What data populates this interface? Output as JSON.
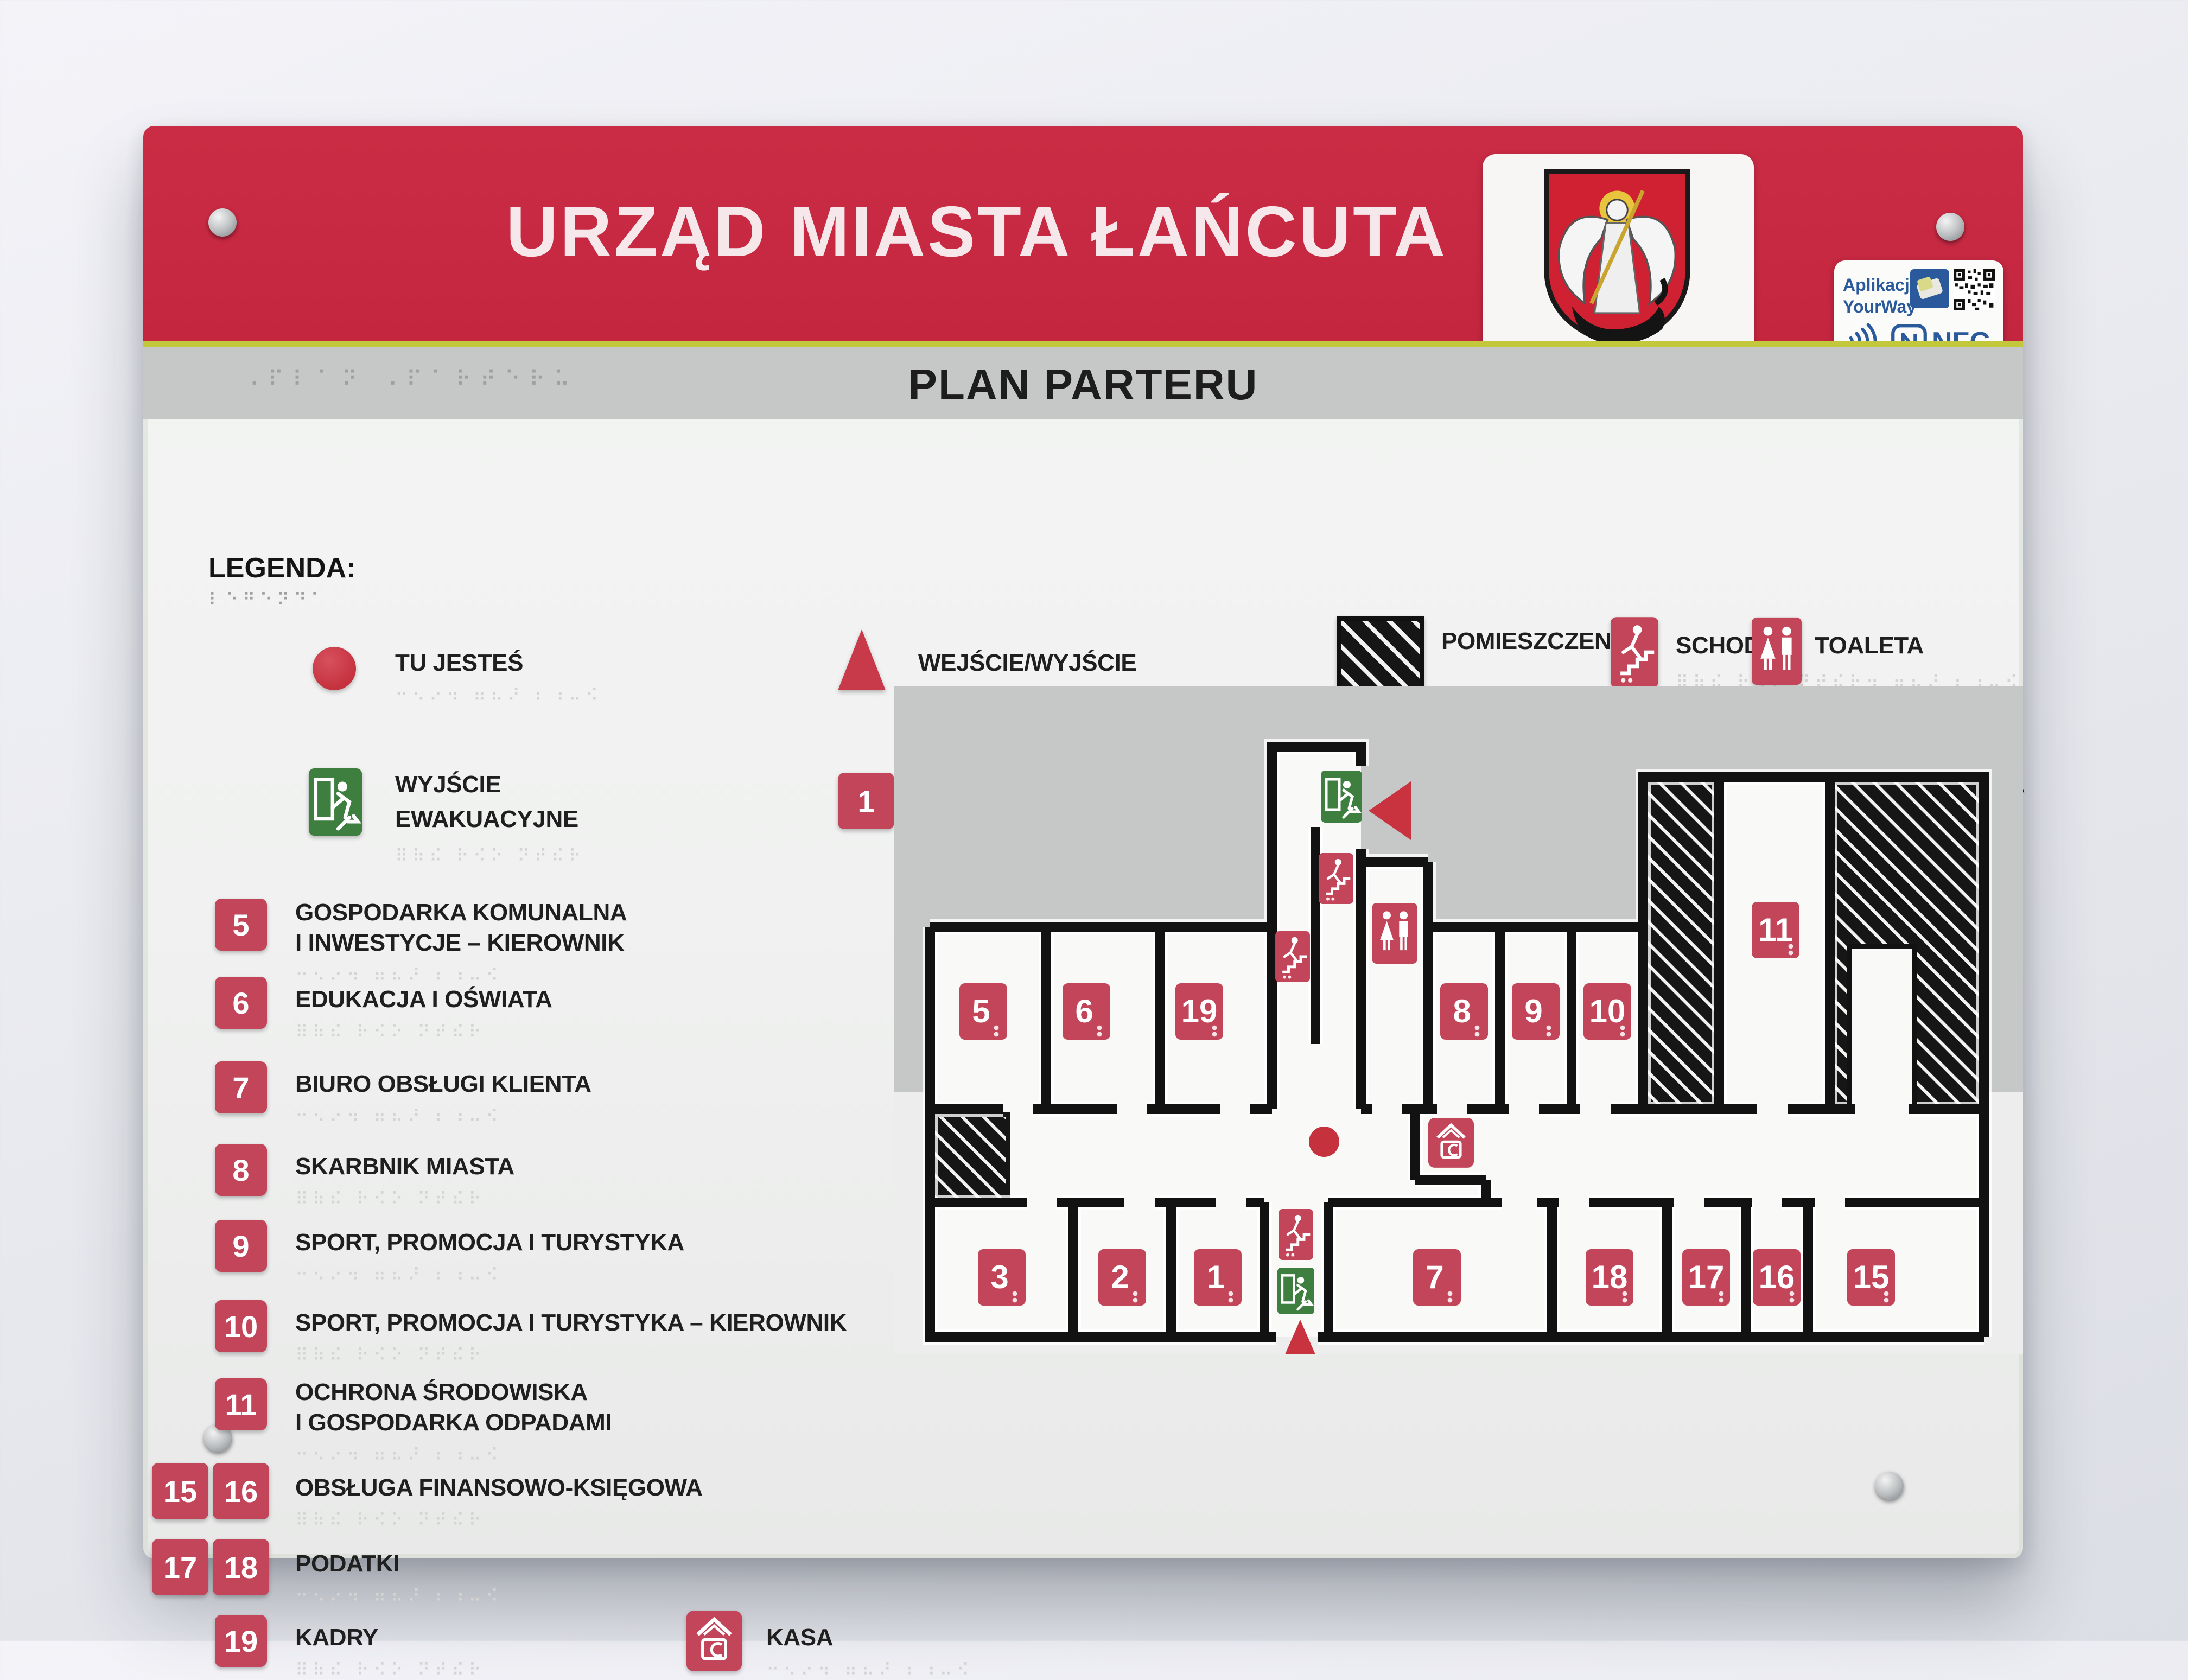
{
  "sign": {
    "header_title": "URZĄD MIASTA ŁAŃCUTA",
    "plan_title": "PLAN PARTERU",
    "badge": {
      "app_line1": "Aplikacja",
      "app_line2": "YourWay",
      "nfc_label": "NFC"
    },
    "colors": {
      "header_red": "#c62a42",
      "tile_red": "#c2455a",
      "exit_green": "#3e7e3f",
      "accent_yellow": "#c3c73c",
      "wall_black": "#121212",
      "plan_grey": "#c6c8c7"
    }
  },
  "legend": {
    "heading": "LEGENDA:",
    "symbols": [
      {
        "name": "tu-jestes",
        "lines": [
          "TU JESTEŚ"
        ]
      },
      {
        "name": "wejscie-wyjscie",
        "lines": [
          "WEJŚCIE/WYJŚCIE"
        ]
      },
      {
        "name": "pomieszczenia-niedostepne",
        "lines": [
          "POMIESZCZENIA",
          "NIEDOSTĘPNE"
        ]
      },
      {
        "name": "schody",
        "lines": [
          "SCHODY"
        ]
      },
      {
        "name": "toaleta",
        "lines": [
          "TOALETA"
        ]
      },
      {
        "name": "wyjscie-ewakuacyjne",
        "lines": [
          "WYJŚCIE",
          "EWAKUACYJNE"
        ]
      },
      {
        "name": "strefa-1",
        "num": "1",
        "lines": [
          "EDUKACJA, KULTURA",
          "I ZDROWIE – KIEROWNIK"
        ]
      },
      {
        "name": "strefa-2",
        "num": "2",
        "lines": [
          "OCHRONA ZDROWIA,",
          "EWIDENCJA DZIAŁALNOŚCI",
          "GOSPODARCZEJ"
        ]
      },
      {
        "name": "strefa-3",
        "num": "3",
        "lines": [
          "GOSPODARKA KOMUNALNA",
          "I INWESTYCJE"
        ]
      }
    ],
    "rooms": [
      {
        "num": "5",
        "lines": [
          "GOSPODARKA KOMUNALNA",
          "I INWESTYCJE – KIEROWNIK"
        ]
      },
      {
        "num": "6",
        "lines": [
          "EDUKACJA I OŚWIATA"
        ]
      },
      {
        "num": "7",
        "lines": [
          "BIURO OBSŁUGI KLIENTA"
        ]
      },
      {
        "num": "8",
        "lines": [
          "SKARBNIK MIASTA"
        ]
      },
      {
        "num": "9",
        "lines": [
          "SPORT, PROMOCJA I TURYSTYKA"
        ]
      },
      {
        "num": "10",
        "lines": [
          "SPORT, PROMOCJA I TURYSTYKA – KIEROWNIK"
        ]
      },
      {
        "num": "11",
        "lines": [
          "OCHRONA ŚRODOWISKA",
          "I GOSPODARKA ODPADAMI"
        ]
      },
      {
        "num": "15",
        "num2": "16",
        "lines": [
          "OBSŁUGA FINANSOWO-KSIĘGOWA"
        ]
      },
      {
        "num": "17",
        "num2": "18",
        "lines": [
          "PODATKI"
        ]
      },
      {
        "num": "19",
        "lines": [
          "KADRY"
        ]
      }
    ],
    "kasa_label": "KASA"
  },
  "floor_plan": {
    "tiles": [
      "5",
      "6",
      "19",
      "8",
      "9",
      "10",
      "11",
      "3",
      "2",
      "1",
      "7",
      "18",
      "17",
      "16",
      "15"
    ]
  },
  "decor": {
    "braille_title": "⠠⠏⠇⠁⠝ ⠠⠏⠁⠗⠞⠑⠗⠥",
    "braille_legend": "⠇⠑⠛⠑⠝⠙⠁",
    "braille_row": "⠒⠢⠔⠲ ⠶⠦⠜ ⠆⠰⠤⠪",
    "braille_row2": "⠿⠷⠮ ⠗⠪⠕ ⠝⠞⠮⠗"
  }
}
